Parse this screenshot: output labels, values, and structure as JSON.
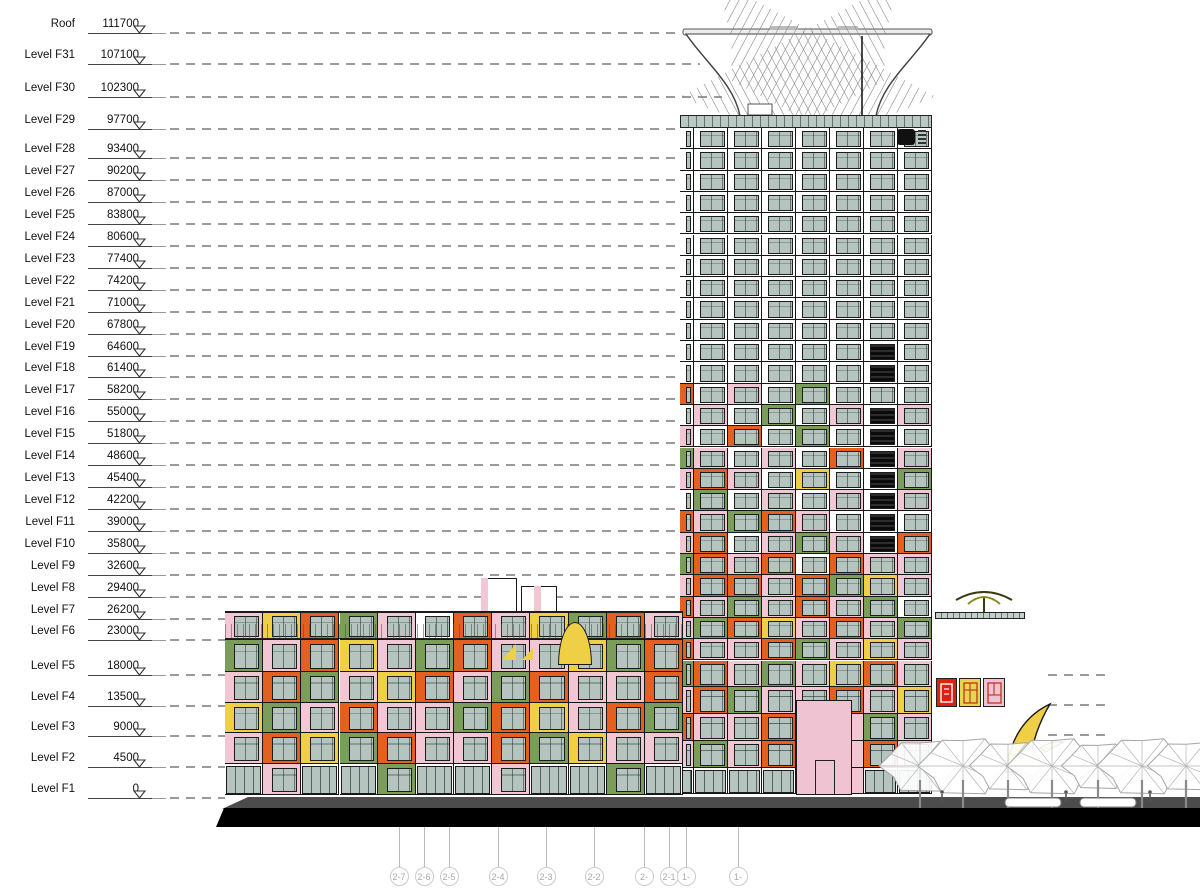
{
  "drawing": {
    "type": "building-elevation",
    "units_note": "elevations in millimetres",
    "levels": [
      {
        "name": "Roof",
        "elevation": 111700
      },
      {
        "name": "Level F31",
        "elevation": 107100
      },
      {
        "name": "Level F30",
        "elevation": 102300
      },
      {
        "name": "Level F29",
        "elevation": 97700
      },
      {
        "name": "Level F28",
        "elevation": 93400
      },
      {
        "name": "Level F27",
        "elevation": 90200
      },
      {
        "name": "Level F26",
        "elevation": 87000
      },
      {
        "name": "Level F25",
        "elevation": 83800
      },
      {
        "name": "Level F24",
        "elevation": 80600
      },
      {
        "name": "Level F23",
        "elevation": 77400
      },
      {
        "name": "Level F22",
        "elevation": 74200
      },
      {
        "name": "Level F21",
        "elevation": 71000
      },
      {
        "name": "Level F20",
        "elevation": 67800
      },
      {
        "name": "Level F19",
        "elevation": 64600
      },
      {
        "name": "Level F18",
        "elevation": 61400
      },
      {
        "name": "Level F17",
        "elevation": 58200
      },
      {
        "name": "Level F16",
        "elevation": 55000
      },
      {
        "name": "Level F15",
        "elevation": 51800
      },
      {
        "name": "Level F14",
        "elevation": 48600
      },
      {
        "name": "Level F13",
        "elevation": 45400
      },
      {
        "name": "Level F12",
        "elevation": 42200
      },
      {
        "name": "Level F11",
        "elevation": 39000
      },
      {
        "name": "Level F10",
        "elevation": 35800
      },
      {
        "name": "Level F9",
        "elevation": 32600
      },
      {
        "name": "Level F8",
        "elevation": 29400
      },
      {
        "name": "Level F7",
        "elevation": 26200
      },
      {
        "name": "Level F6",
        "elevation": 23000
      },
      {
        "name": "Level F5",
        "elevation": 18000
      },
      {
        "name": "Level F4",
        "elevation": 13500
      },
      {
        "name": "Level F3",
        "elevation": 9000
      },
      {
        "name": "Level F2",
        "elevation": 4500
      },
      {
        "name": "Level F1",
        "elevation": 0
      }
    ],
    "grid_bubbles": [
      {
        "label": "2-7",
        "x": 399
      },
      {
        "label": "2-6",
        "x": 424
      },
      {
        "label": "2-5",
        "x": 449
      },
      {
        "label": "2-4",
        "x": 498
      },
      {
        "label": "2-3",
        "x": 546
      },
      {
        "label": "2-2",
        "x": 594
      },
      {
        "label": "2-1/1",
        "x": 644
      },
      {
        "label": "2-1",
        "x": 669
      },
      {
        "label": "1-11",
        "x": 686
      },
      {
        "label": "1-10",
        "x": 738
      }
    ],
    "signs": {
      "hotel_panels": [
        "囻",
        "酒",
        "店"
      ]
    },
    "palette": {
      "glass": "#b6c4c0",
      "pink": "#f2c6d3",
      "orange": "#e55f1e",
      "green": "#7a9e5a",
      "yellow": "#eecf45",
      "dark_window": "#0b0b0b",
      "sign_red": "#e01f10",
      "band_teal": "#b9c8c3",
      "dash_gray": "#9a9a9a"
    },
    "tower_pattern": [
      "WWWWWWWW",
      "WWWWWWWW",
      "WWWWWWWW",
      "WWWWWWWW",
      "WWWWWWWW",
      "WWWWWWWW",
      "WWWWWWWW",
      "WWWWWWWW",
      "WWWWWWWW",
      "WWWWWWWW",
      "WWWWWWKW",
      "WWWWWWKW",
      "OWPWGWWW",
      "WPWGWPKP",
      "PWOWGWKW",
      "GPWPWOKP",
      "POPWYWKG",
      "WGWPWPKP",
      "OPGOPWKW",
      "POWPGPKO",
      "GOPOWOPP",
      "POOPOGYP",
      "OPGPOPGW",
      "PGOYPOPG",
      "OPPOGPYP",
      "GOPGPYOP",
      "POGPPOPY",
      "OPPOEEGP",
      "PGPOEEOP",
      "SSSSEESS"
    ],
    "podium_pattern": [
      "PYOGPWOPYGOP",
      "GPOYPGOPPYGO",
      "POGPYOPGOPPO",
      "YGPOPPGOYPOG",
      "POYGOPPOGYPP",
      "SPSSGSSPSSGS"
    ],
    "wing_pattern": [
      "PYO",
      "OGP",
      "PYP",
      "GPO",
      "POG"
    ],
    "scene": {
      "trees_x_r": [
        [
          920,
          38
        ],
        [
          963,
          42
        ],
        [
          1008,
          36
        ],
        [
          1052,
          42
        ],
        [
          1098,
          34
        ],
        [
          1142,
          42
        ],
        [
          1186,
          36
        ]
      ],
      "people_x": [
        942,
        1066,
        1150
      ]
    }
  }
}
